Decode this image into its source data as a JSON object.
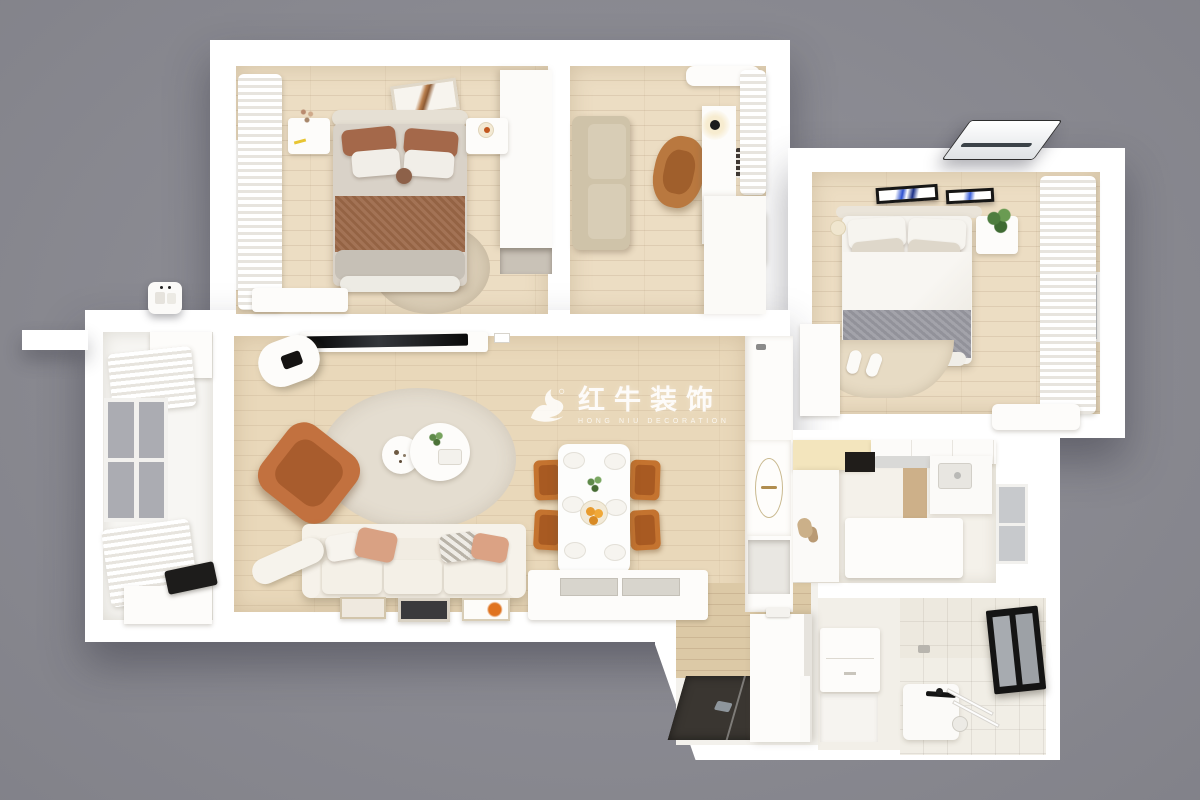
{
  "watermark": {
    "icon": "bull-logo-icon",
    "title": "红牛装饰",
    "subtitle": "HONG NIU DECORATION"
  },
  "colors": {
    "bg": "#8d8d95",
    "wall": "#ffffff",
    "wood": "#ecddc3",
    "wood2": "#e9d8ba",
    "balcony": "#f7f6f3",
    "tile": "#f1eee6",
    "tilewall": "#ede9df",
    "terracotta": "#c2713f",
    "chairtan": "#b9783f",
    "beigesofa": "#cfc3a9",
    "cream": "#f3e5bd",
    "brownbed": "#a4684a",
    "brownblanket": "#9c6848",
    "grayblanket": "#9b9ba3",
    "darkmat": "#3a3631",
    "entrywood": "#dcc9a6",
    "wm": "#ffffff"
  }
}
